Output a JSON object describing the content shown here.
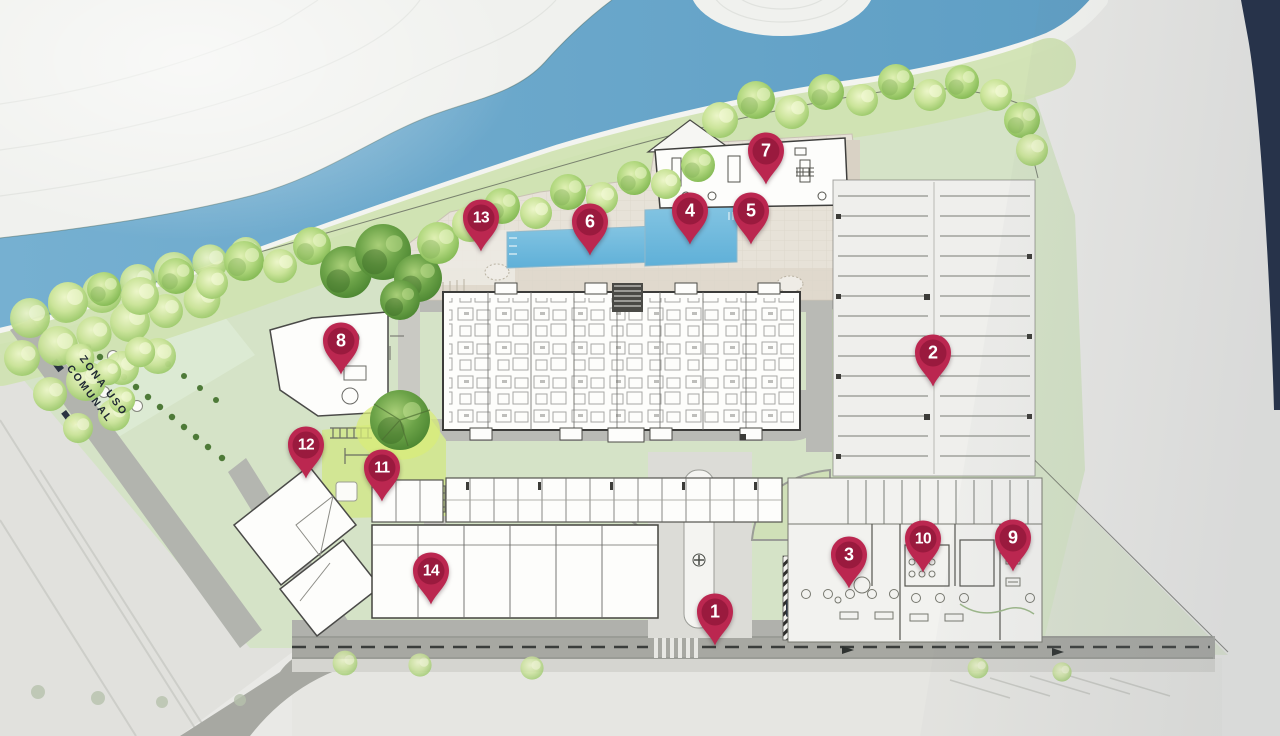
{
  "plan": {
    "type": "site-plan",
    "zone_label": {
      "line1": "ZONA USO",
      "line2": "COMUNAL"
    },
    "marker_color": "#bb2750",
    "marker_color_dark": "#9a1a3e",
    "river_color": "#6aa6c9",
    "lawn_color": "#d5e3c7",
    "playground_color": "#d2e694",
    "road_color": "#a7a8a2",
    "markers": [
      {
        "number": "1",
        "x": 715,
        "y": 612
      },
      {
        "number": "2",
        "x": 933,
        "y": 353
      },
      {
        "number": "3",
        "x": 849,
        "y": 555
      },
      {
        "number": "4",
        "x": 690,
        "y": 211
      },
      {
        "number": "5",
        "x": 751,
        "y": 211
      },
      {
        "number": "6",
        "x": 590,
        "y": 222
      },
      {
        "number": "7",
        "x": 766,
        "y": 151
      },
      {
        "number": "8",
        "x": 341,
        "y": 341
      },
      {
        "number": "9",
        "x": 1013,
        "y": 538
      },
      {
        "number": "10",
        "x": 923,
        "y": 539
      },
      {
        "number": "11",
        "x": 382,
        "y": 468
      },
      {
        "number": "12",
        "x": 306,
        "y": 445
      },
      {
        "number": "13",
        "x": 481,
        "y": 218
      },
      {
        "number": "14",
        "x": 431,
        "y": 571
      }
    ]
  }
}
